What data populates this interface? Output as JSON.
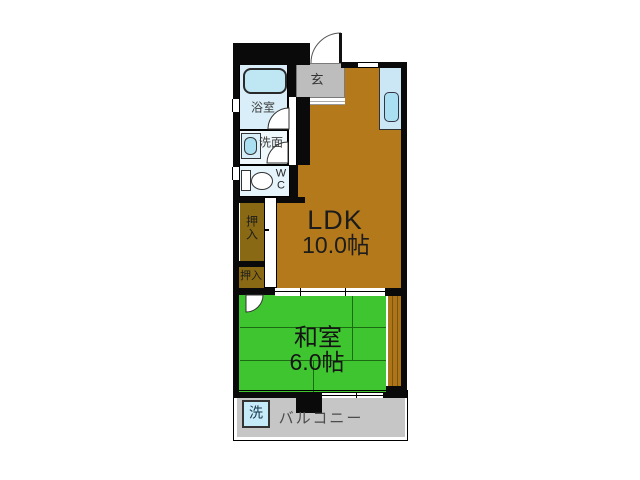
{
  "floor_plan": {
    "rooms": {
      "ldk": {
        "label": "LDK",
        "size": "10.0帖"
      },
      "japanese_room": {
        "label": "和室",
        "size": "6.0帖"
      },
      "bathroom": {
        "label": "浴室"
      },
      "washroom": {
        "label": "洗面"
      },
      "toilet": {
        "line1": "W",
        "line2": "C"
      },
      "entrance": {
        "label": "玄"
      },
      "closet_upper": {
        "line1": "押",
        "line2": "入"
      },
      "closet_lower": {
        "label": "押入"
      },
      "balcony": {
        "label": "バルコニー"
      },
      "laundry": {
        "label": "洗"
      }
    },
    "colors": {
      "wall": "#0a0a0a",
      "ldk_floor": "#b4791b",
      "tatami_green": "#3fc52f",
      "closet_olive": "#8a6914",
      "wet_room_blue": "#d9eef8",
      "fixture_blue": "#a9dff0",
      "entrance_gray": "#bdbdbd",
      "balcony_gray": "#c6c6c6",
      "counter_teal": "#2f6a60"
    }
  }
}
